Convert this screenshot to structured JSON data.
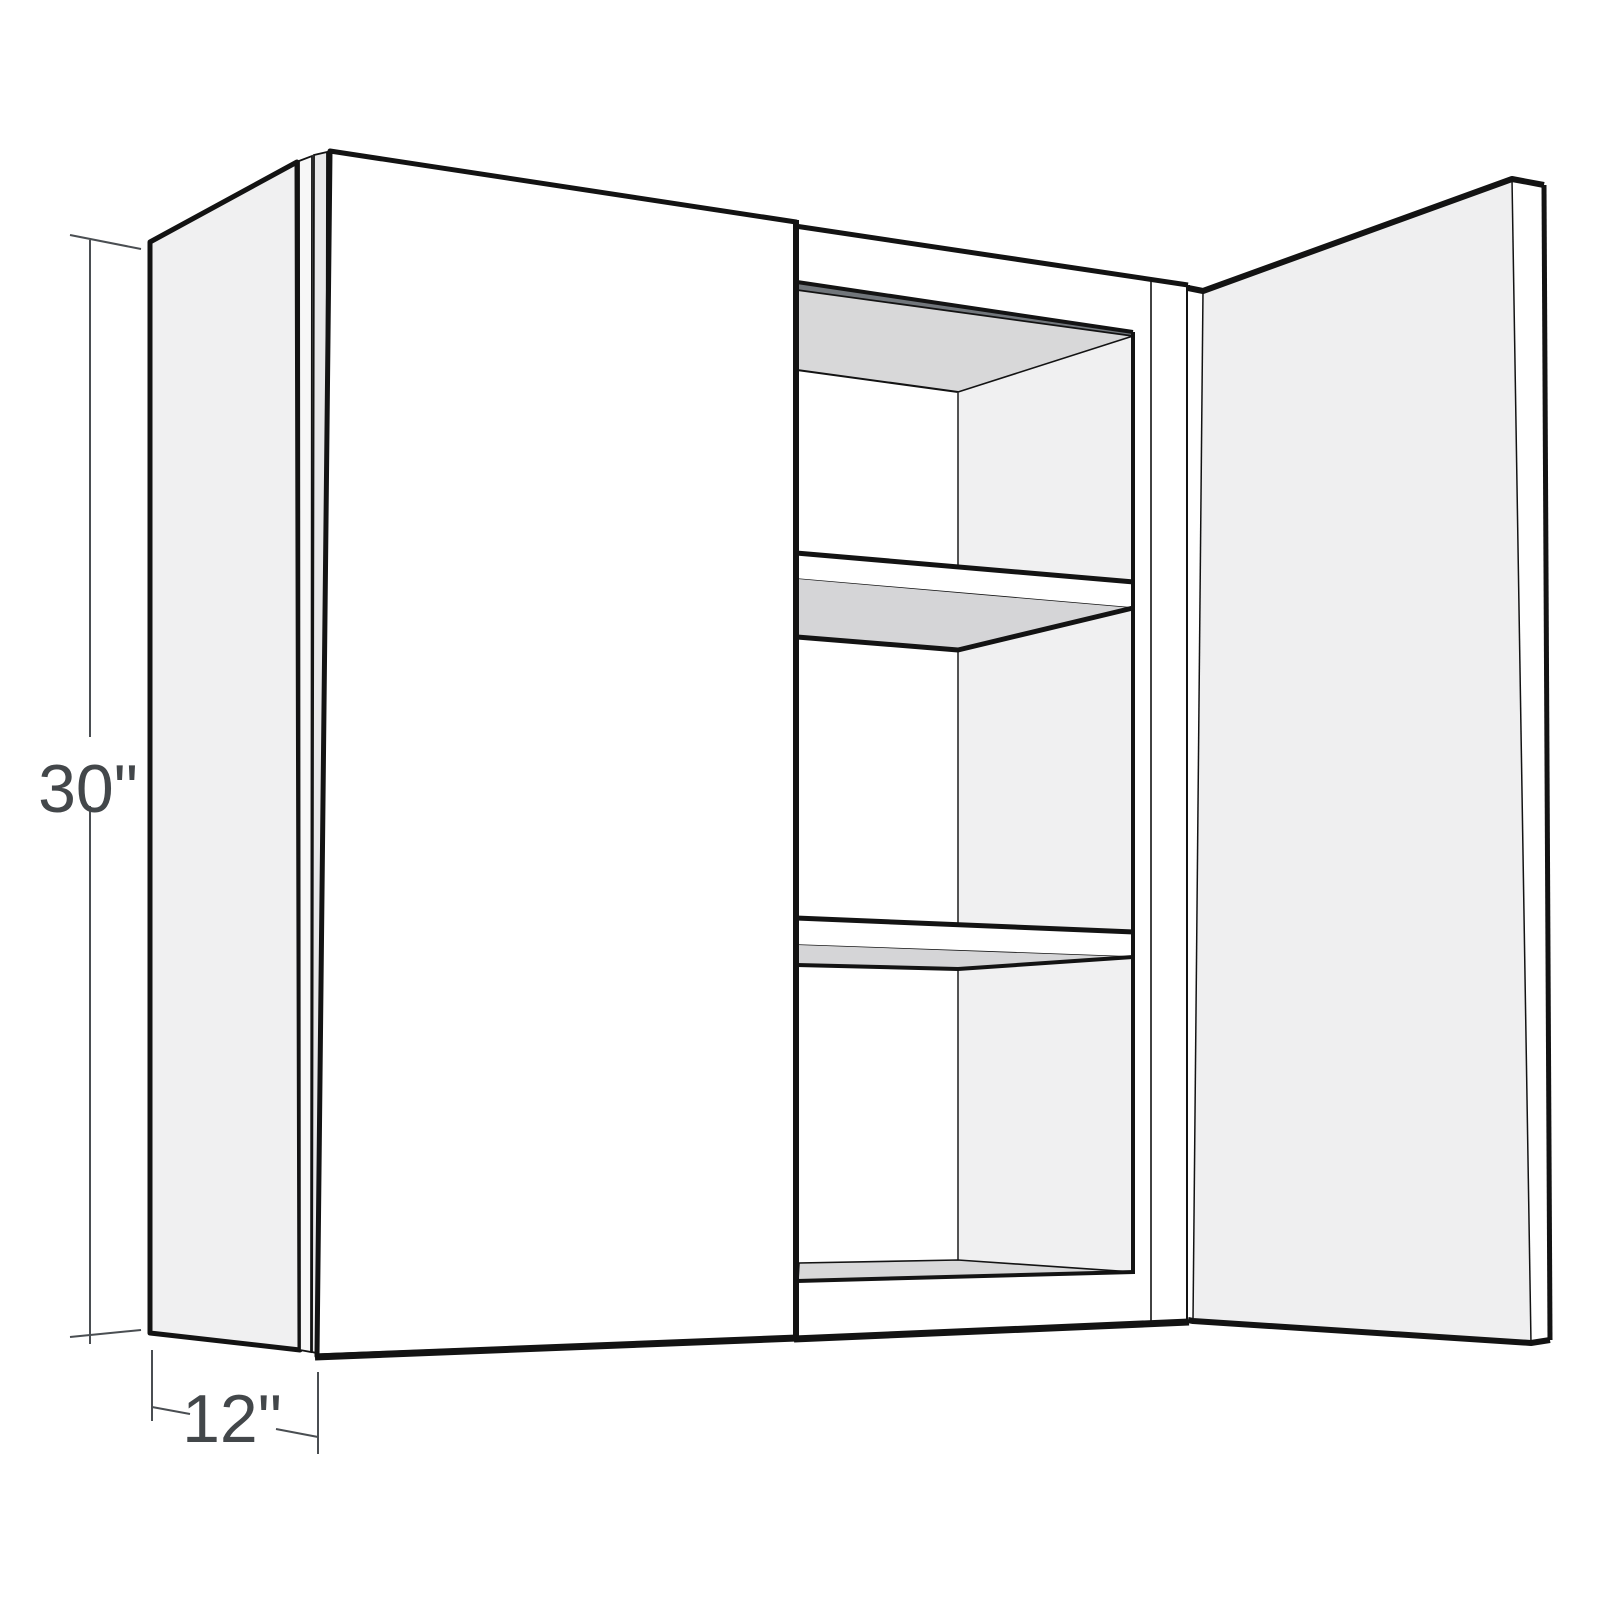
{
  "diagram": {
    "name": "open-wall-cabinet-line-drawing",
    "height_dimension": "30\"",
    "depth_dimension": "12\"",
    "door_count": 2,
    "shelf_count": 2,
    "compartment_count": 3
  },
  "colors": {
    "background": "#ffffff",
    "outline": "#131313",
    "side_panel": "#f0f0f1",
    "door_face": "#ffffff",
    "door_inner_face": "#efeff0",
    "interior_wall": "#f0f0f1",
    "interior_shaded": "#d8d8d9",
    "shelf_underside": "#d5d5d7",
    "top_back_rail": "#71767b",
    "edge_strip": "#e9e9ea",
    "edge_strip_light": "#f7f7f7",
    "dimension_line": "#4a4e52",
    "dimension_text": "#43474a"
  }
}
